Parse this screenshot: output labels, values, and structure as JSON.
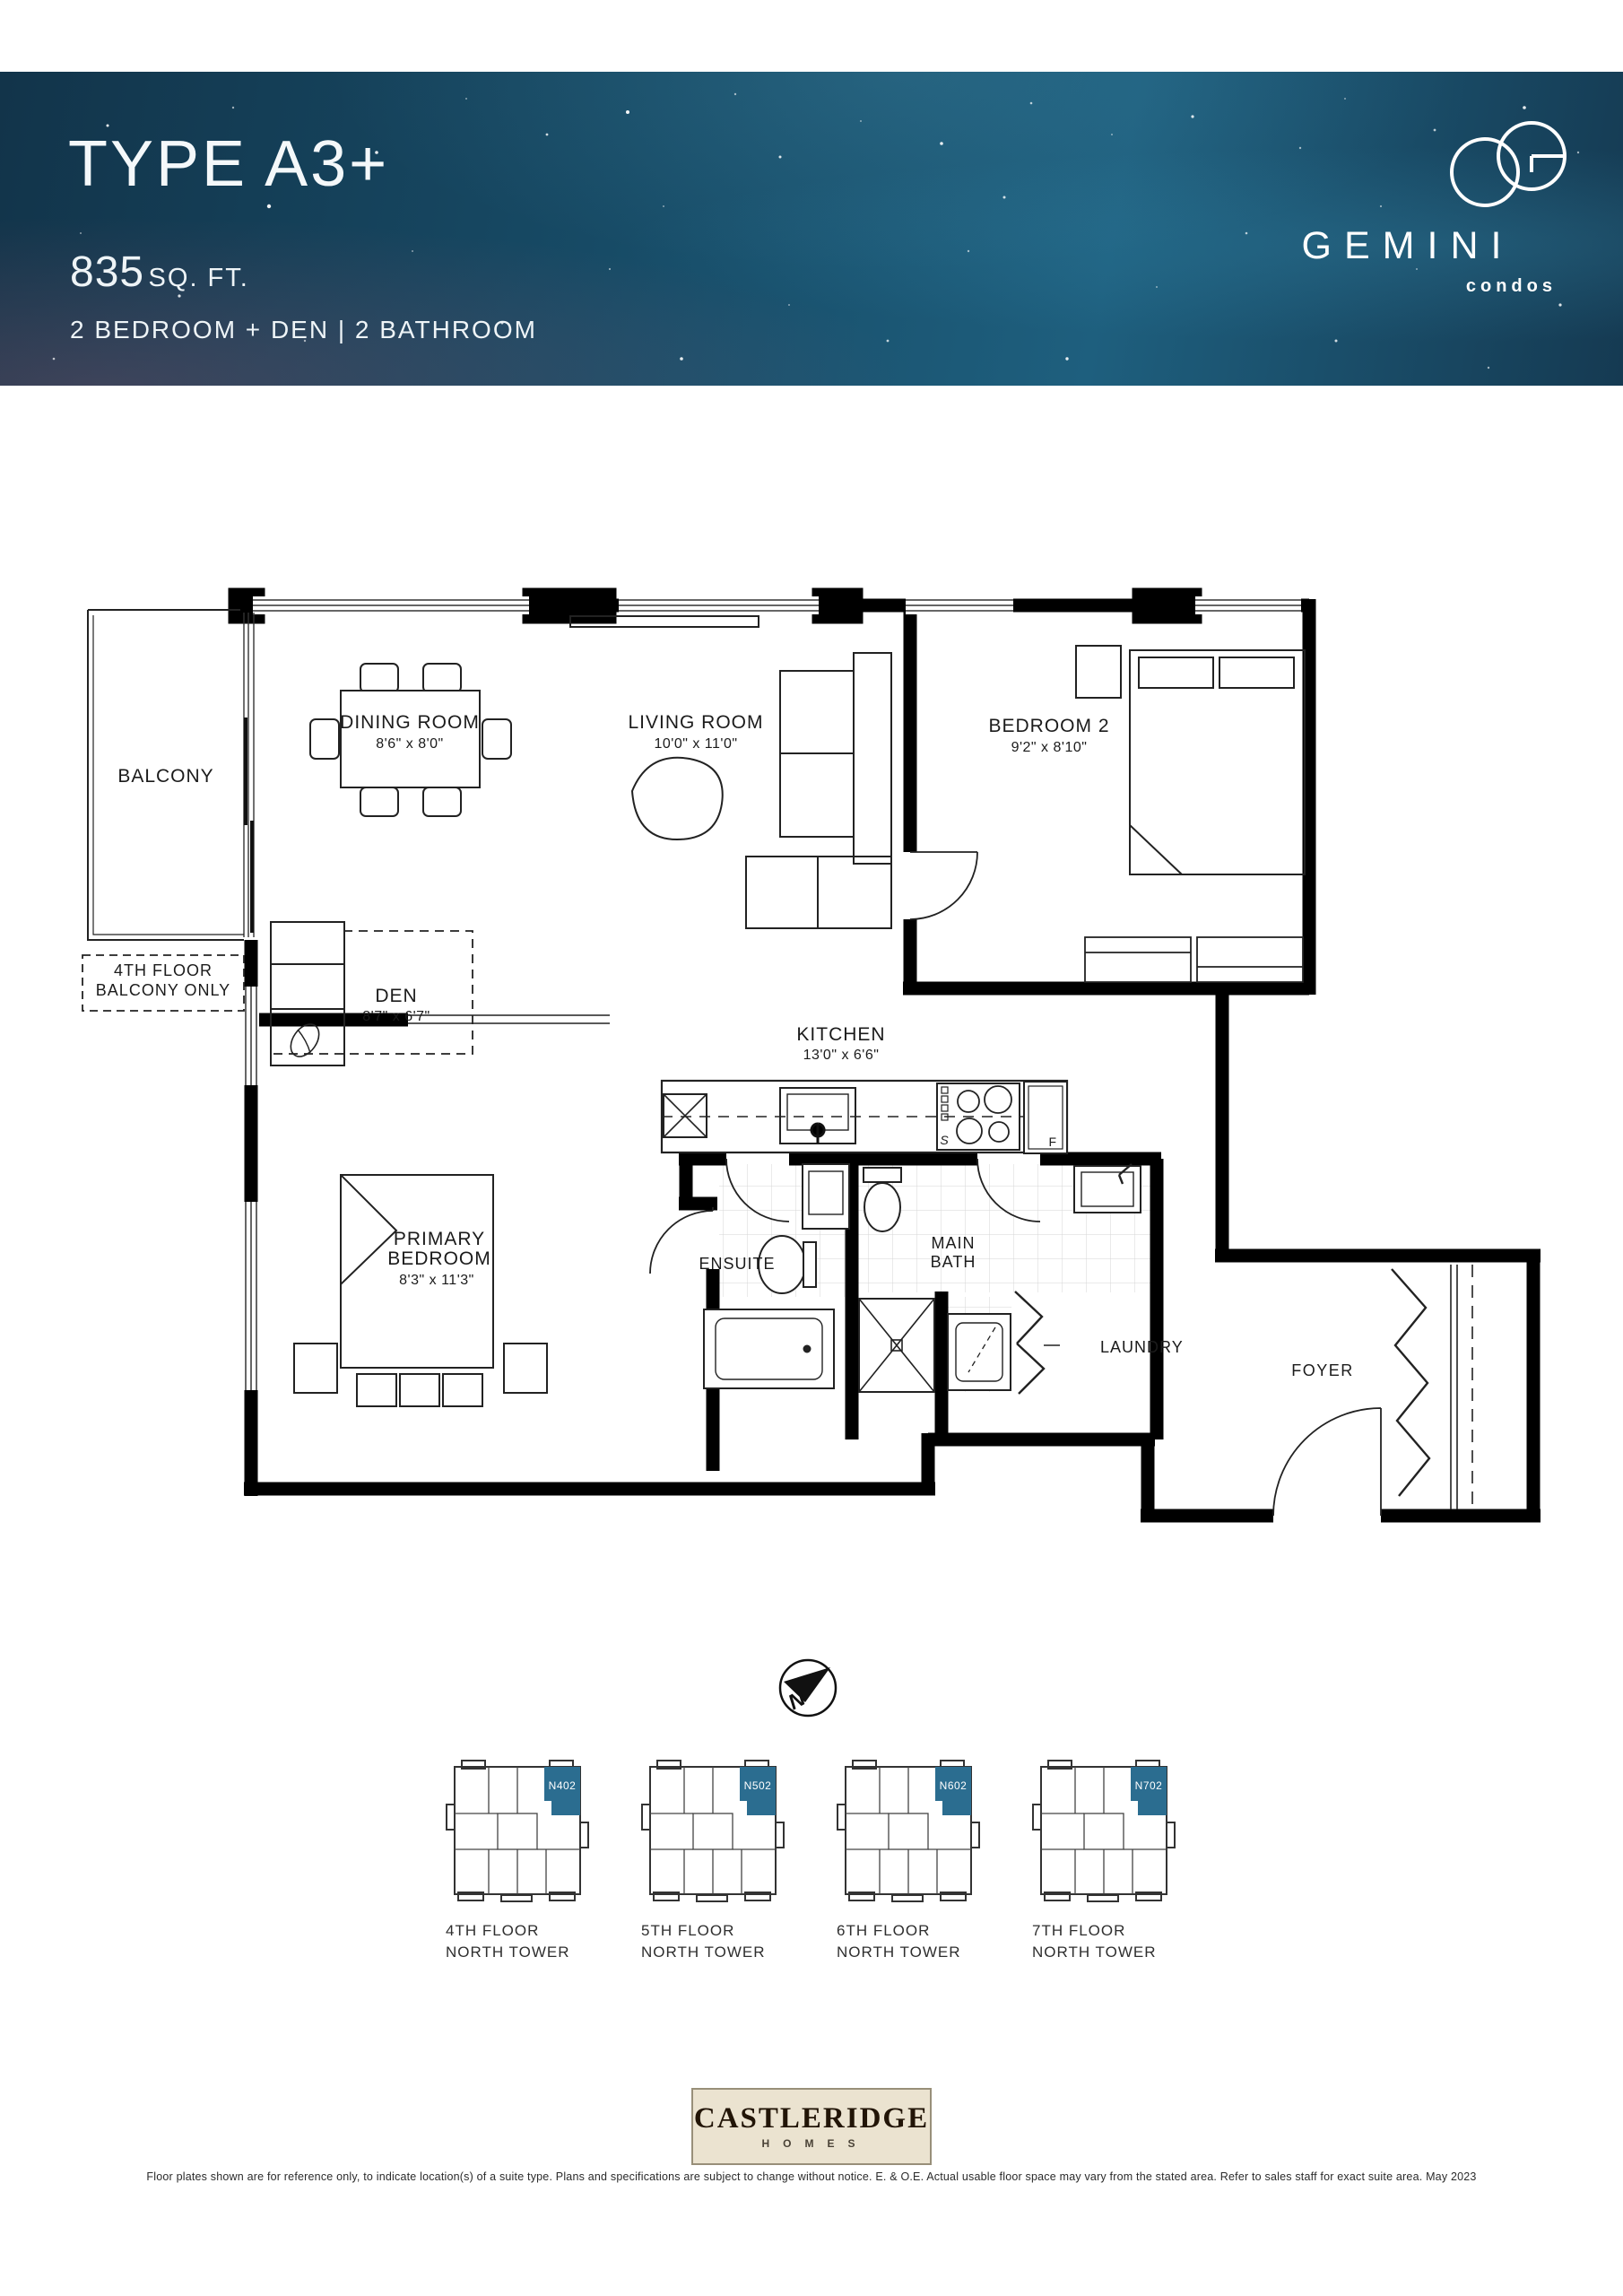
{
  "header": {
    "title": "TYPE A3+",
    "area_value": "835",
    "area_unit": "SQ. FT.",
    "config": "2 BEDROOM + DEN  |  2 BATHROOM",
    "brand_name": "GEMINI",
    "brand_sub": "condos"
  },
  "floorplan": {
    "balcony": "BALCONY",
    "balcony_note1": "4TH FLOOR",
    "balcony_note2": "BALCONY ONLY",
    "dining_name": "DINING ROOM",
    "dining_dims": "8'6\" x 8'0\"",
    "living_name": "LIVING ROOM",
    "living_dims": "10'0\" x 11'0\"",
    "bedroom2_name": "BEDROOM 2",
    "bedroom2_dims": "9'2\" x 8'10\"",
    "den_name": "DEN",
    "den_dims": "8'7\" x 6'7\"",
    "kitchen_name": "KITCHEN",
    "kitchen_dims": "13'0\" x 6'6\"",
    "primary_name1": "PRIMARY",
    "primary_name2": "BEDROOM",
    "primary_dims": "8'3\" x 11'3\"",
    "ensuite": "ENSUITE",
    "mainbath1": "MAIN",
    "mainbath2": "BATH",
    "laundry": "LAUNDRY",
    "foyer": "FOYER",
    "stove": "S",
    "fridge": "F"
  },
  "compass": {
    "north": "N"
  },
  "keyplans": {
    "highlight_color": "#2b6d90",
    "items": [
      {
        "unit": "N402",
        "floor": "4TH FLOOR",
        "tower": "NORTH TOWER"
      },
      {
        "unit": "N502",
        "floor": "5TH FLOOR",
        "tower": "NORTH TOWER"
      },
      {
        "unit": "N602",
        "floor": "6TH FLOOR",
        "tower": "NORTH TOWER"
      },
      {
        "unit": "N702",
        "floor": "7TH FLOOR",
        "tower": "NORTH TOWER"
      }
    ]
  },
  "builder": {
    "name": "CASTLERIDGE",
    "sub": "HOMES"
  },
  "disclaimer": "Floor plates shown are for reference only, to indicate location(s) of a suite type. Plans and specifications are subject to change without notice. E. & O.E. Actual usable floor space may vary from the stated area. Refer to sales staff for exact suite area. May 2023"
}
